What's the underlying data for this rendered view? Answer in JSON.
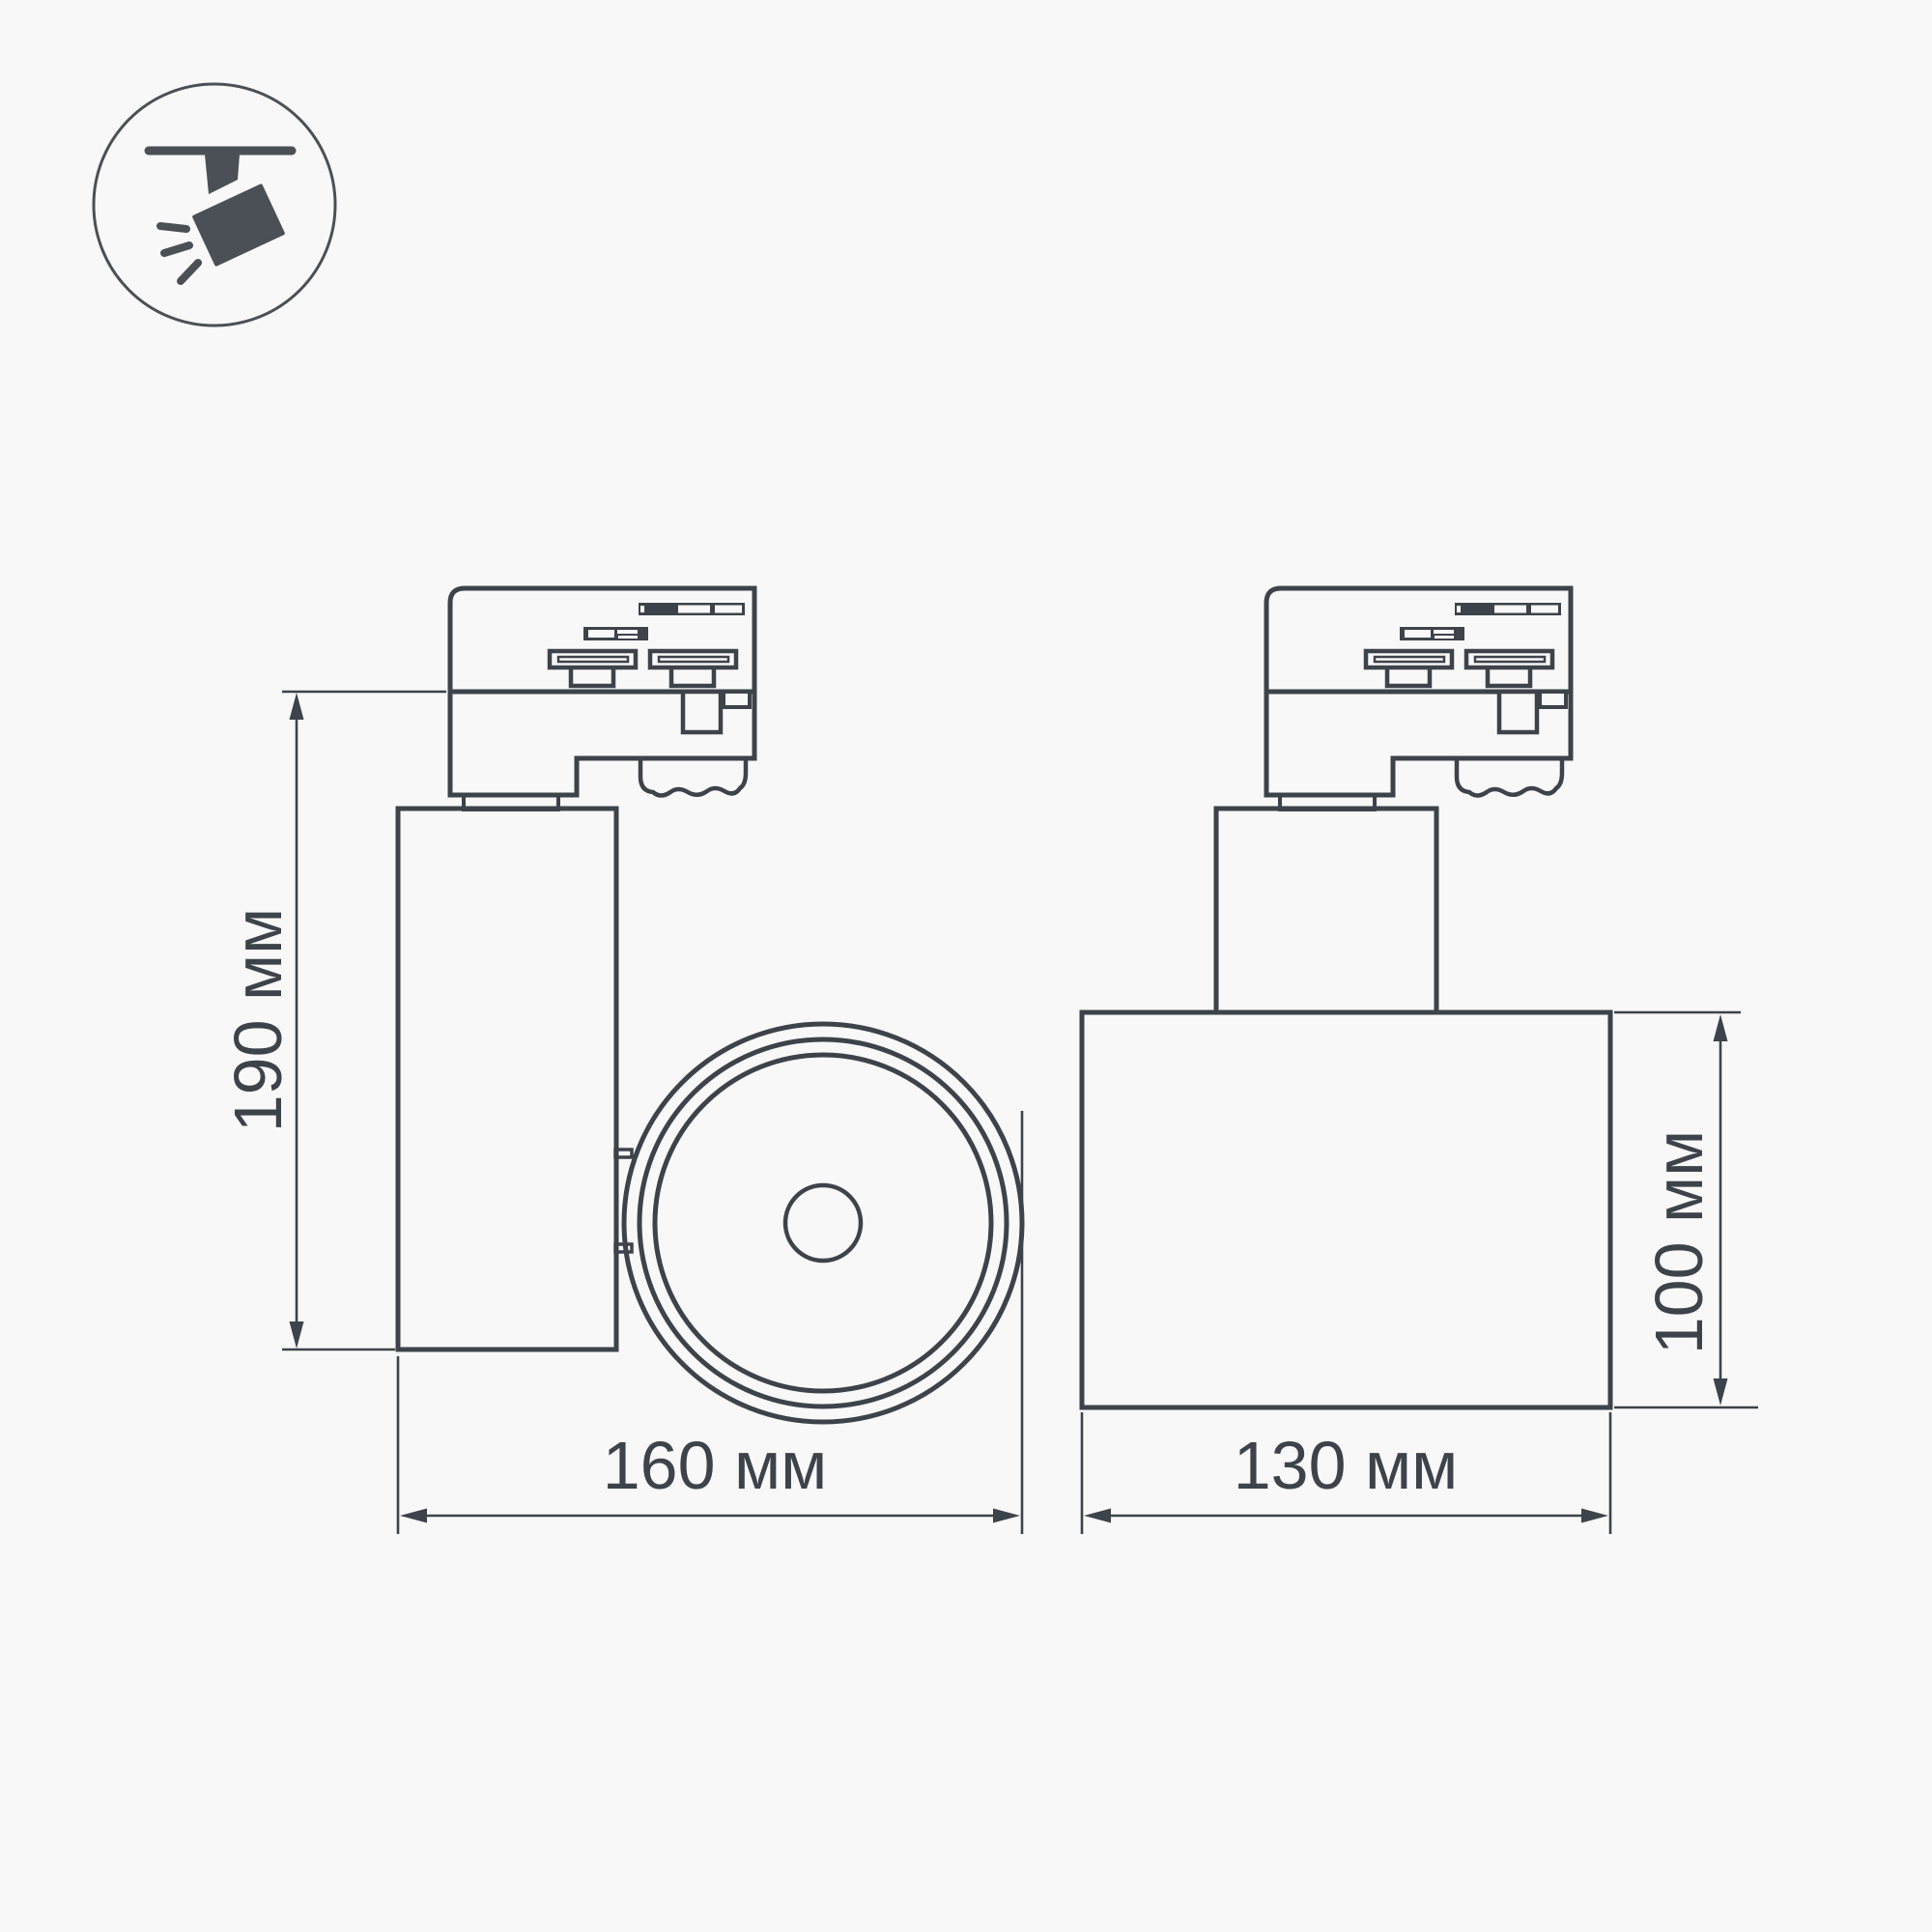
{
  "theme": {
    "background": "#f8f8f8",
    "line_color": "#3d434a",
    "icon_color": "#4a5056"
  },
  "badge": {
    "meaning": "track-mounted adjustable spotlight pictogram"
  },
  "drawing": {
    "type": "technical dimension drawing, two orthographic views of LED track spotlight",
    "unit": "мм",
    "side_view": {
      "height": {
        "value": 190,
        "unit": "мм",
        "label": "190 мм"
      },
      "width": {
        "value": 160,
        "unit": "мм",
        "label": "160 мм"
      }
    },
    "front_view": {
      "width": {
        "value": 130,
        "unit": "мм",
        "label": "130 мм"
      },
      "height": {
        "value": 100,
        "unit": "мм",
        "label": "100 мм"
      }
    }
  }
}
